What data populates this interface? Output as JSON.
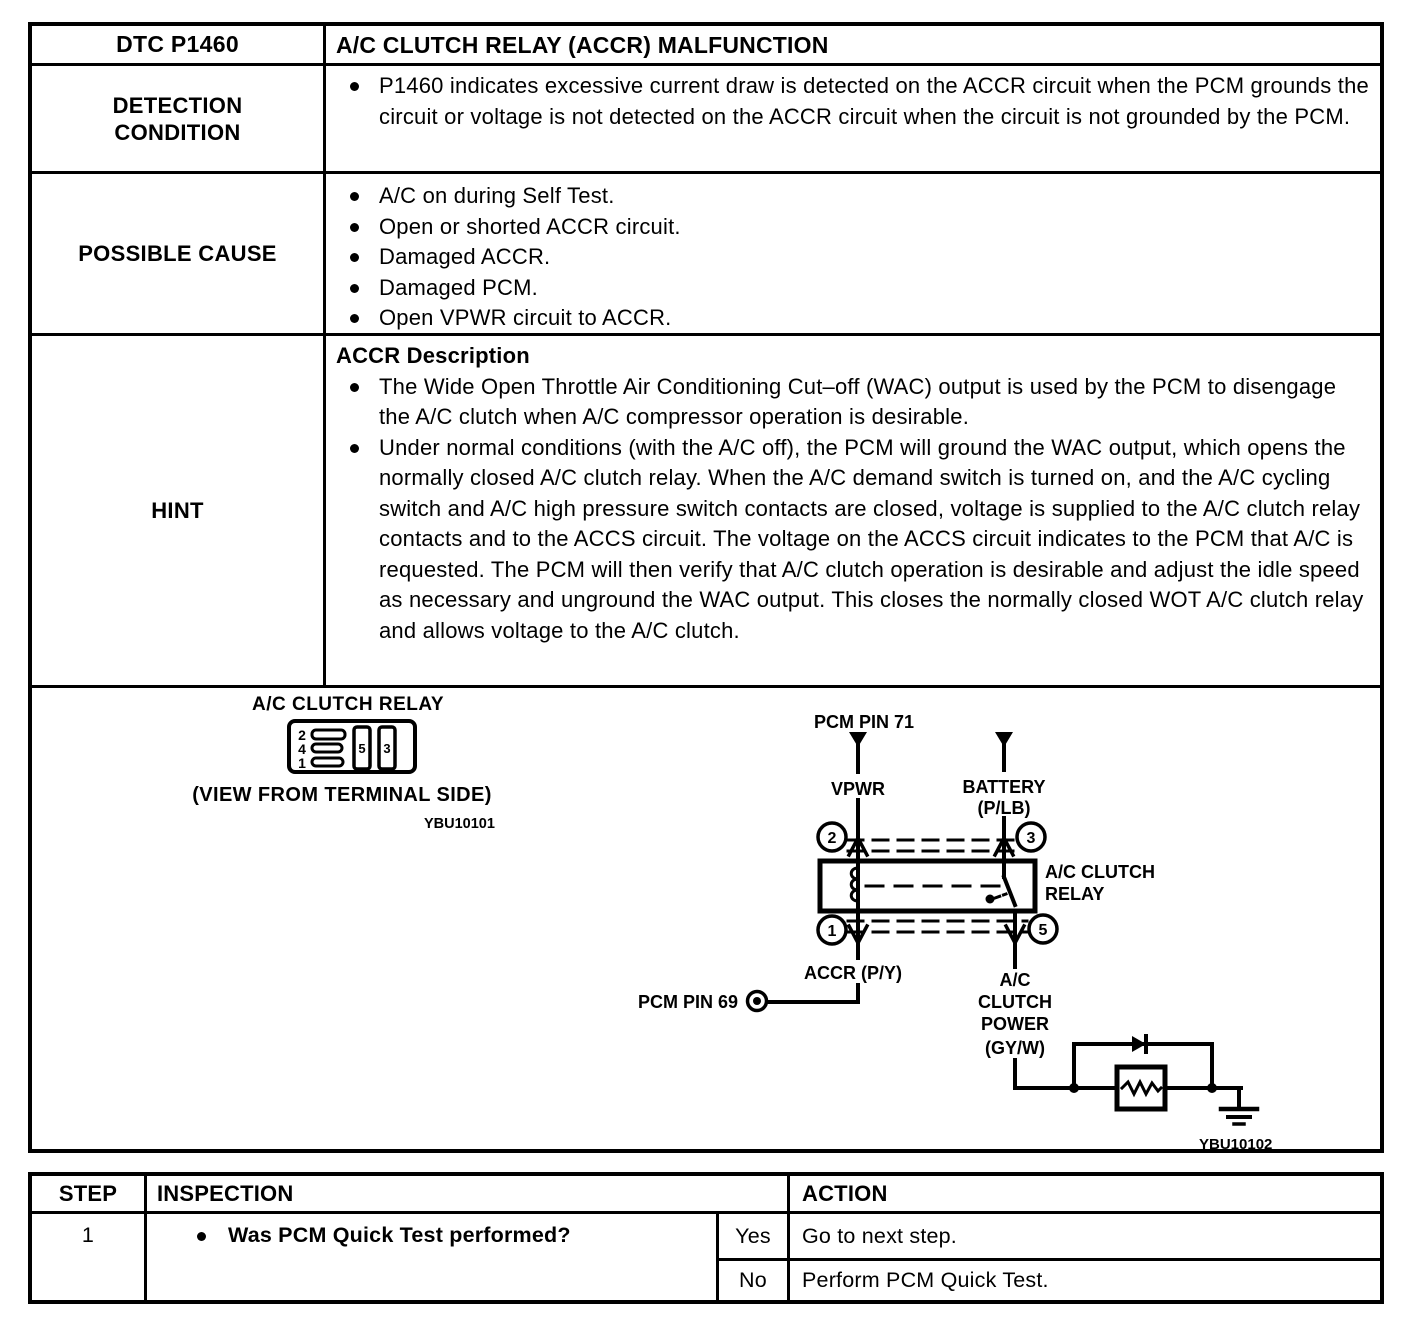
{
  "colors": {
    "ink": "#000000",
    "paper": "#ffffff"
  },
  "main_table": {
    "title_row": {
      "code": "DTC P1460",
      "title": "A/C CLUTCH RELAY (ACCR) MALFUNCTION"
    },
    "detection": {
      "label_line1": "DETECTION",
      "label_line2": "CONDITION",
      "items": [
        "P1460 indicates excessive current draw is detected on the ACCR circuit when the PCM grounds the circuit or voltage is not detected on the ACCR circuit when the circuit is not grounded by the PCM."
      ]
    },
    "possible_cause": {
      "label": "POSSIBLE CAUSE",
      "items": [
        "A/C on during Self Test.",
        "Open or shorted ACCR circuit.",
        "Damaged ACCR.",
        "Damaged PCM.",
        "Open VPWR circuit to ACCR."
      ]
    },
    "hint": {
      "label": "HINT",
      "heading": "ACCR Description",
      "items": [
        "The Wide Open Throttle Air Conditioning Cut–off (WAC) output is used by the PCM to disengage the A/C clutch when A/C compressor operation is desirable.",
        "Under normal conditions (with the A/C off), the PCM will ground the WAC output, which opens the normally closed A/C clutch relay. When the A/C demand switch is turned on, and the A/C cycling switch and A/C high pressure switch contacts are closed, voltage is supplied to the A/C clutch relay contacts and to the ACCS circuit. The voltage on the ACCS circuit indicates to the PCM that A/C is requested. The PCM will then verify that A/C clutch operation is desirable and adjust the idle speed as necessary and unground the WAC output. This closes the normally closed WOT A/C clutch relay and allows voltage to the A/C clutch."
      ]
    }
  },
  "figure": {
    "relay_view": {
      "title": "A/C CLUTCH RELAY",
      "caption": "(VIEW FROM TERMINAL SIDE)",
      "figure_id": "YBU10101",
      "terminals": [
        "2",
        "4",
        "1"
      ],
      "slots": [
        "5",
        "3"
      ]
    },
    "schematic": {
      "pcm_pin_71": "PCM PIN 71",
      "vpwr": "VPWR",
      "battery": "BATTERY",
      "battery_wire": "(P/LB)",
      "pin_top_left": "2",
      "pin_top_right": "3",
      "pin_bottom_left": "1",
      "pin_bottom_right": "5",
      "relay_label_1": "A/C CLUTCH",
      "relay_label_2": "RELAY",
      "accr_wire": "ACCR (P/Y)",
      "pcm_pin_69": "PCM PIN 69",
      "clutch_power_1": "A/C",
      "clutch_power_2": "CLUTCH",
      "clutch_power_3": "POWER",
      "clutch_power_4": "(GY/W)",
      "figure_id": "YBU10102"
    }
  },
  "steps_table": {
    "headers": {
      "step": "STEP",
      "inspection": "INSPECTION",
      "action": "ACTION"
    },
    "rows": [
      {
        "step": "1",
        "inspection": "Was PCM Quick Test performed?",
        "answers": [
          {
            "label": "Yes",
            "action": "Go to next step."
          },
          {
            "label": "No",
            "action": "Perform PCM Quick Test."
          }
        ]
      }
    ]
  }
}
